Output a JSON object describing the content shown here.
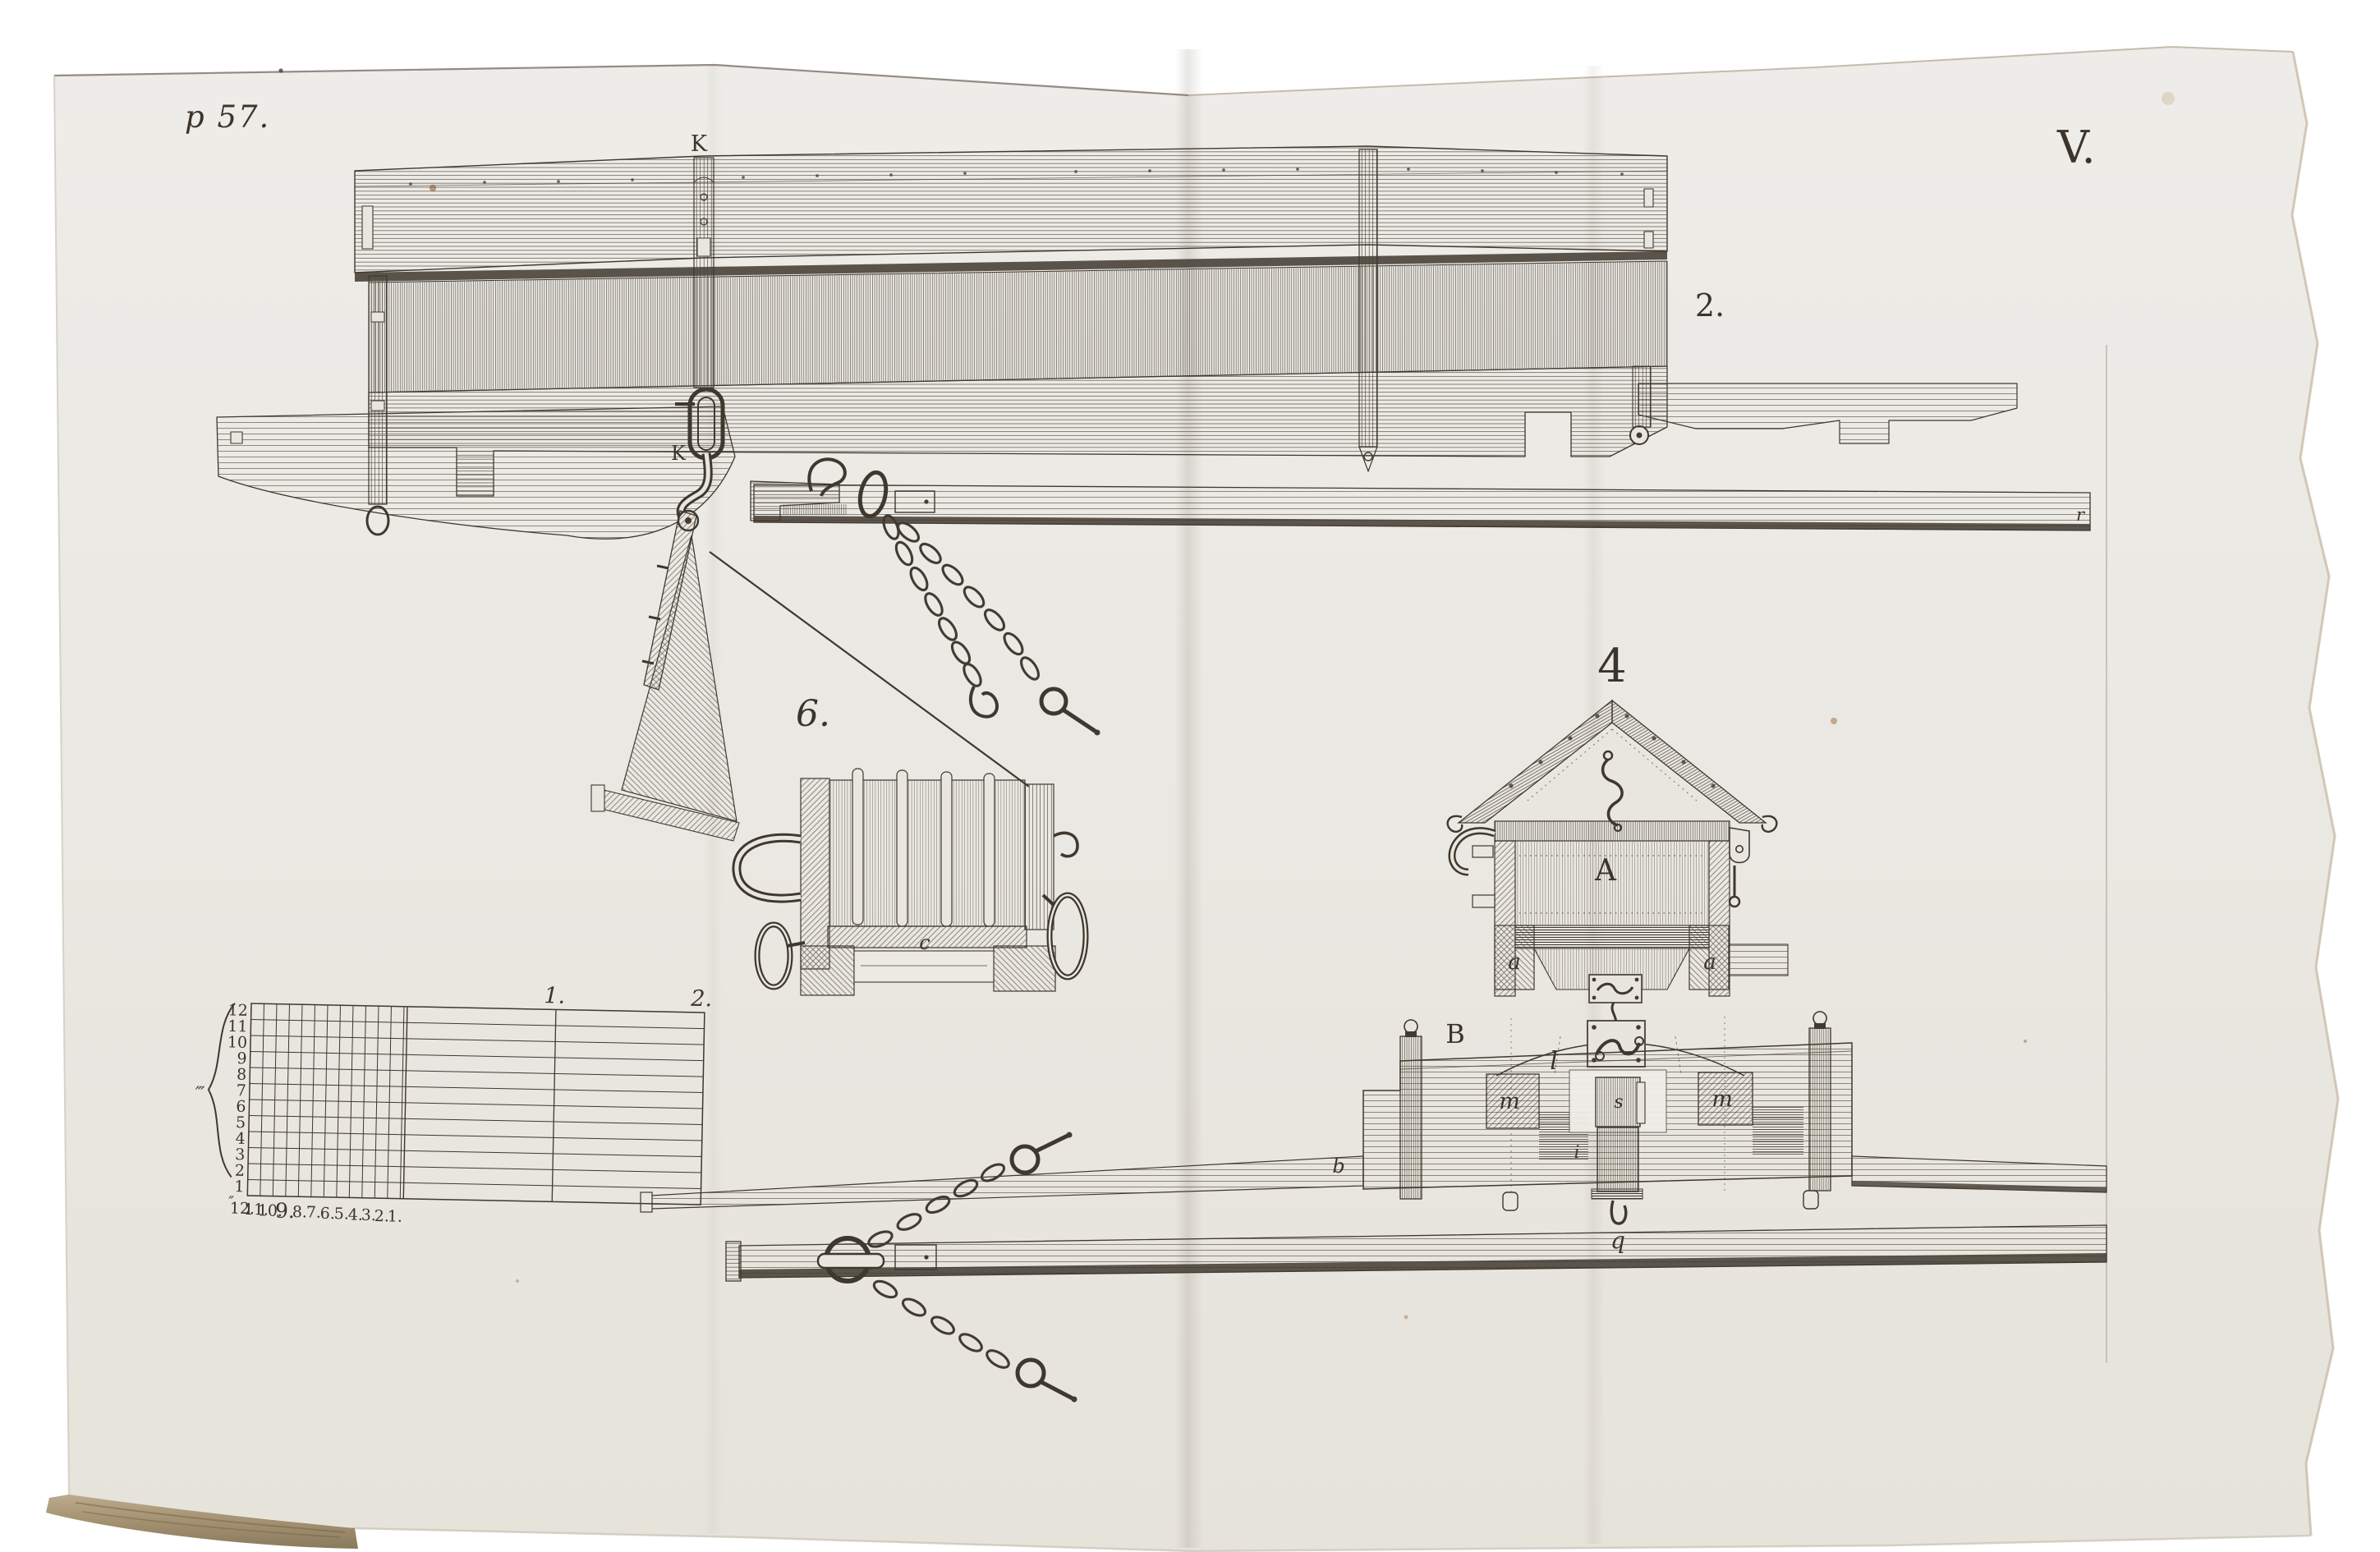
{
  "plate": {
    "page_ref": "p 57.",
    "plate_number": "V.",
    "fig2_label": "2.",
    "fig2_strap_label": "K",
    "fig2_hook_label": "K",
    "pole_end_label": "r",
    "fig6_label": "6.",
    "fig6_part_c": "c",
    "fig4_label": "4",
    "fig4_hopper": "A",
    "fig4_base_left": "a",
    "fig4_base_right": "a",
    "fig4_body": "B",
    "fig4_link": "l",
    "fig4_block_left": "m",
    "fig4_slide": "s",
    "fig4_block_right": "m",
    "fig4_pole": "b",
    "fig4_pin": "i",
    "fig4_hook": "q",
    "colors": {
      "paper": "#ebe9e4",
      "ink": "#423b31",
      "board_tan": "#a9977b"
    }
  },
  "scale_ruler": {
    "left_numbers": [
      "12",
      "11",
      "10",
      "9",
      "8",
      "7",
      "6",
      "5",
      "4",
      "3",
      "2",
      "1"
    ],
    "bottom_numbers": [
      "12.",
      "11.",
      "10.",
      "9.",
      "8.",
      "7.",
      "6.",
      "5.",
      "4.",
      "3.",
      "2.",
      "1."
    ],
    "top_marks": [
      "1.",
      "2."
    ],
    "tick_marks": [
      "‴",
      "″"
    ]
  }
}
